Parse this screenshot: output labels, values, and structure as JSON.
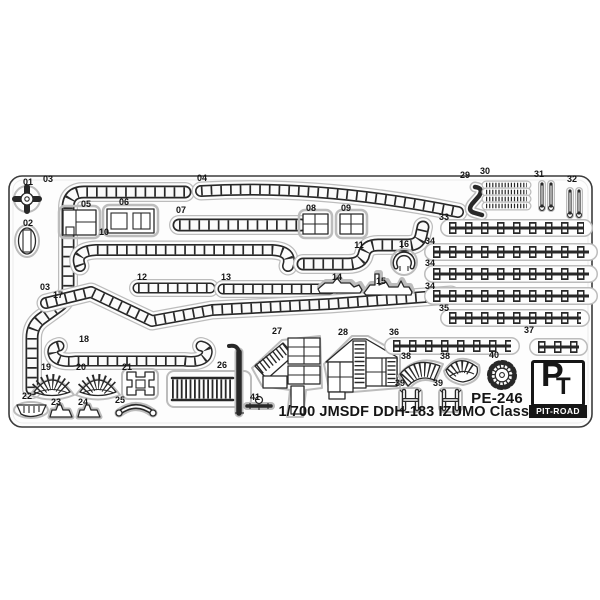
{
  "sheet": {
    "code": "PE-246",
    "title": "1/700 JMSDF DDH-183 IZUMO Class",
    "brand": "PIT-ROAD",
    "monogram_p": "P",
    "monogram_t": "T",
    "colors": {
      "ink": "#282828",
      "plate": "#fdfdfd",
      "etch_outline": "#bcbcbc",
      "logo": "#161616"
    },
    "part_labels": [
      {
        "t": "01",
        "x": 28,
        "y": 185
      },
      {
        "t": "02",
        "x": 28,
        "y": 226
      },
      {
        "t": "03",
        "x": 48,
        "y": 182
      },
      {
        "t": "03",
        "x": 45,
        "y": 290
      },
      {
        "t": "04",
        "x": 202,
        "y": 181
      },
      {
        "t": "05",
        "x": 86,
        "y": 207
      },
      {
        "t": "06",
        "x": 124,
        "y": 205
      },
      {
        "t": "07",
        "x": 181,
        "y": 213
      },
      {
        "t": "08",
        "x": 311,
        "y": 211
      },
      {
        "t": "09",
        "x": 346,
        "y": 211
      },
      {
        "t": "10",
        "x": 104,
        "y": 235
      },
      {
        "t": "11",
        "x": 359,
        "y": 248
      },
      {
        "t": "12",
        "x": 142,
        "y": 280
      },
      {
        "t": "13",
        "x": 226,
        "y": 280
      },
      {
        "t": "14",
        "x": 337,
        "y": 280
      },
      {
        "t": "15",
        "x": 381,
        "y": 284
      },
      {
        "t": "16",
        "x": 404,
        "y": 247
      },
      {
        "t": "17",
        "x": 58,
        "y": 298
      },
      {
        "t": "18",
        "x": 84,
        "y": 342
      },
      {
        "t": "19",
        "x": 46,
        "y": 370
      },
      {
        "t": "20",
        "x": 81,
        "y": 370
      },
      {
        "t": "21",
        "x": 127,
        "y": 370
      },
      {
        "t": "22",
        "x": 27,
        "y": 399
      },
      {
        "t": "23",
        "x": 56,
        "y": 405
      },
      {
        "t": "24",
        "x": 83,
        "y": 405
      },
      {
        "t": "25",
        "x": 120,
        "y": 403
      },
      {
        "t": "26",
        "x": 222,
        "y": 368
      },
      {
        "t": "27",
        "x": 277,
        "y": 334
      },
      {
        "t": "28",
        "x": 343,
        "y": 335
      },
      {
        "t": "29",
        "x": 465,
        "y": 178
      },
      {
        "t": "30",
        "x": 485,
        "y": 174
      },
      {
        "t": "31",
        "x": 539,
        "y": 177
      },
      {
        "t": "32",
        "x": 572,
        "y": 182
      },
      {
        "t": "33",
        "x": 444,
        "y": 220
      },
      {
        "t": "34",
        "x": 430,
        "y": 244
      },
      {
        "t": "34",
        "x": 430,
        "y": 266
      },
      {
        "t": "34",
        "x": 430,
        "y": 289
      },
      {
        "t": "35",
        "x": 444,
        "y": 311
      },
      {
        "t": "36",
        "x": 394,
        "y": 335
      },
      {
        "t": "37",
        "x": 529,
        "y": 333
      },
      {
        "t": "38",
        "x": 406,
        "y": 359
      },
      {
        "t": "38",
        "x": 445,
        "y": 359
      },
      {
        "t": "39",
        "x": 400,
        "y": 386
      },
      {
        "t": "39",
        "x": 438,
        "y": 386
      },
      {
        "t": "40",
        "x": 494,
        "y": 358
      },
      {
        "t": "41",
        "x": 255,
        "y": 400
      }
    ]
  }
}
